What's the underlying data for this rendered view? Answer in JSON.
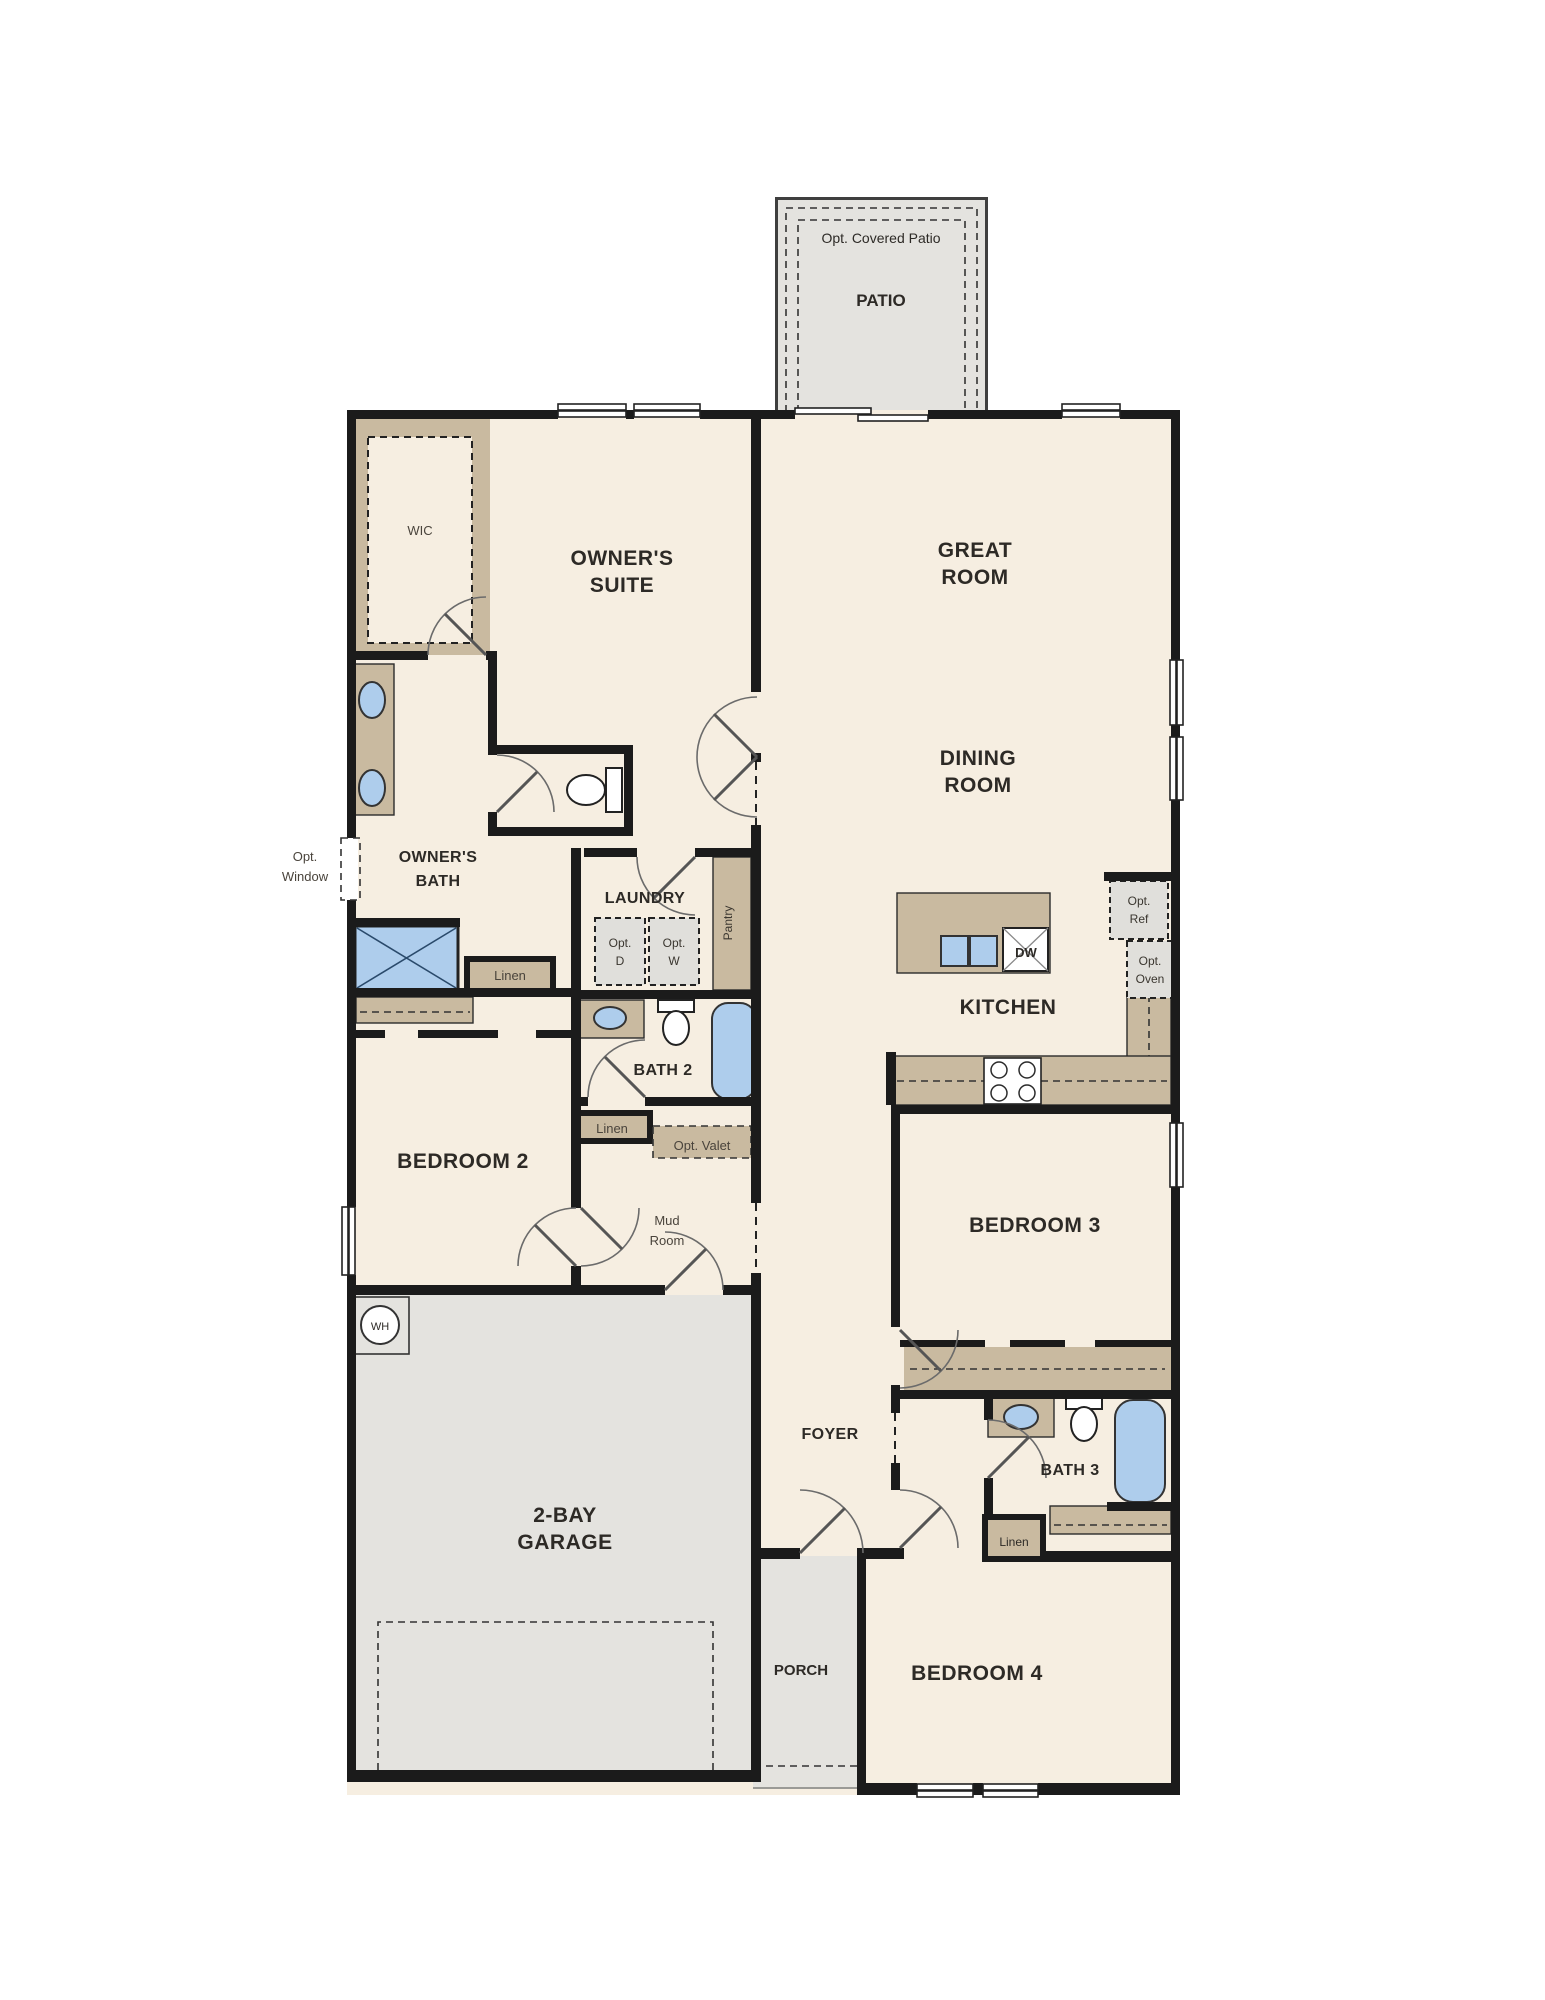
{
  "plan_type": "single-story floor plan",
  "colors": {
    "floor": "#f6eee1",
    "exterior_concrete": "#e4e3df",
    "cabinet_tan": "#c9baa0",
    "wall": "#1b1b1b",
    "fixture_blue": "#aecdec",
    "optional_box": "#e0dfdb",
    "text": "#2d2a26"
  },
  "labels": {
    "opt_covered_patio": "Opt. Covered Patio",
    "patio": "PATIO",
    "wic": "WIC",
    "owners_suite_1": "OWNER'S",
    "owners_suite_2": "SUITE",
    "great_room_1": "GREAT",
    "great_room_2": "ROOM",
    "dining_room_1": "DINING",
    "dining_room_2": "ROOM",
    "opt_window_1": "Opt.",
    "opt_window_2": "Window",
    "owners_bath_1": "OWNER'S",
    "owners_bath_2": "BATH",
    "laundry": "LAUNDRY",
    "opt_d_1": "Opt.",
    "opt_d_2": "D",
    "opt_w_1": "Opt.",
    "opt_w_2": "W",
    "pantry": "Pantry",
    "linen_owners": "Linen",
    "bath2": "BATH 2",
    "kitchen": "KITCHEN",
    "dw": "DW",
    "opt_ref_1": "Opt.",
    "opt_ref_2": "Ref",
    "opt_oven_1": "Opt.",
    "opt_oven_2": "Oven",
    "bedroom2": "BEDROOM 2",
    "linen_hall": "Linen",
    "opt_valet": "Opt. Valet",
    "mud_room_1": "Mud",
    "mud_room_2": "Room",
    "bedroom3": "BEDROOM 3",
    "wh": "WH",
    "foyer": "FOYER",
    "garage_1": "2-BAY",
    "garage_2": "GARAGE",
    "bath3": "BATH 3",
    "linen_bath3": "Linen",
    "porch": "PORCH",
    "bedroom4": "BEDROOM 4"
  },
  "fixtures": [
    "double-vanity-owners-bath",
    "shower-owners-bath",
    "toilet-owners-wc",
    "sink-bath2",
    "toilet-bath2",
    "tub-bath2",
    "kitchen-island-double-sink",
    "dishwasher",
    "range-4-burner",
    "sink-bath3",
    "toilet-bath3",
    "tub-bath3",
    "water-heater"
  ]
}
